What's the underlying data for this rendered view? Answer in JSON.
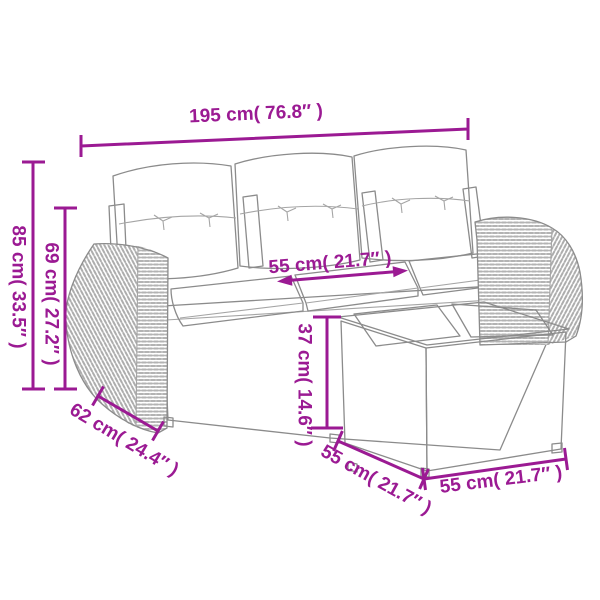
{
  "colors": {
    "dimension_accent": "#9b1a93",
    "line_art": "#8b8b8b",
    "weave": "#b3b3b3",
    "background": "#ffffff",
    "cushion_fill": "#fdfdfb"
  },
  "dimensions": {
    "total_width": {
      "label": "195 cm( 76.8″ )",
      "cm": 195,
      "inches": 76.8
    },
    "total_height": {
      "label": "85 cm( 33.5″ )",
      "cm": 85,
      "inches": 33.5
    },
    "back_height": {
      "label": "69 cm( 27.2″ )",
      "cm": 69,
      "inches": 27.2
    },
    "seat_width": {
      "label": "55 cm( 21.7″ )",
      "cm": 55,
      "inches": 21.7
    },
    "seat_height": {
      "label": "37 cm( 14.6″ )",
      "cm": 37,
      "inches": 14.6
    },
    "arm_depth": {
      "label": "62 cm( 24.4″ )",
      "cm": 62,
      "inches": 24.4
    },
    "table_depth": {
      "label": "55 cm( 21.7″ )",
      "cm": 55,
      "inches": 21.7
    },
    "table_width": {
      "label": "55 cm( 21.7″ )",
      "cm": 55,
      "inches": 21.7
    }
  }
}
